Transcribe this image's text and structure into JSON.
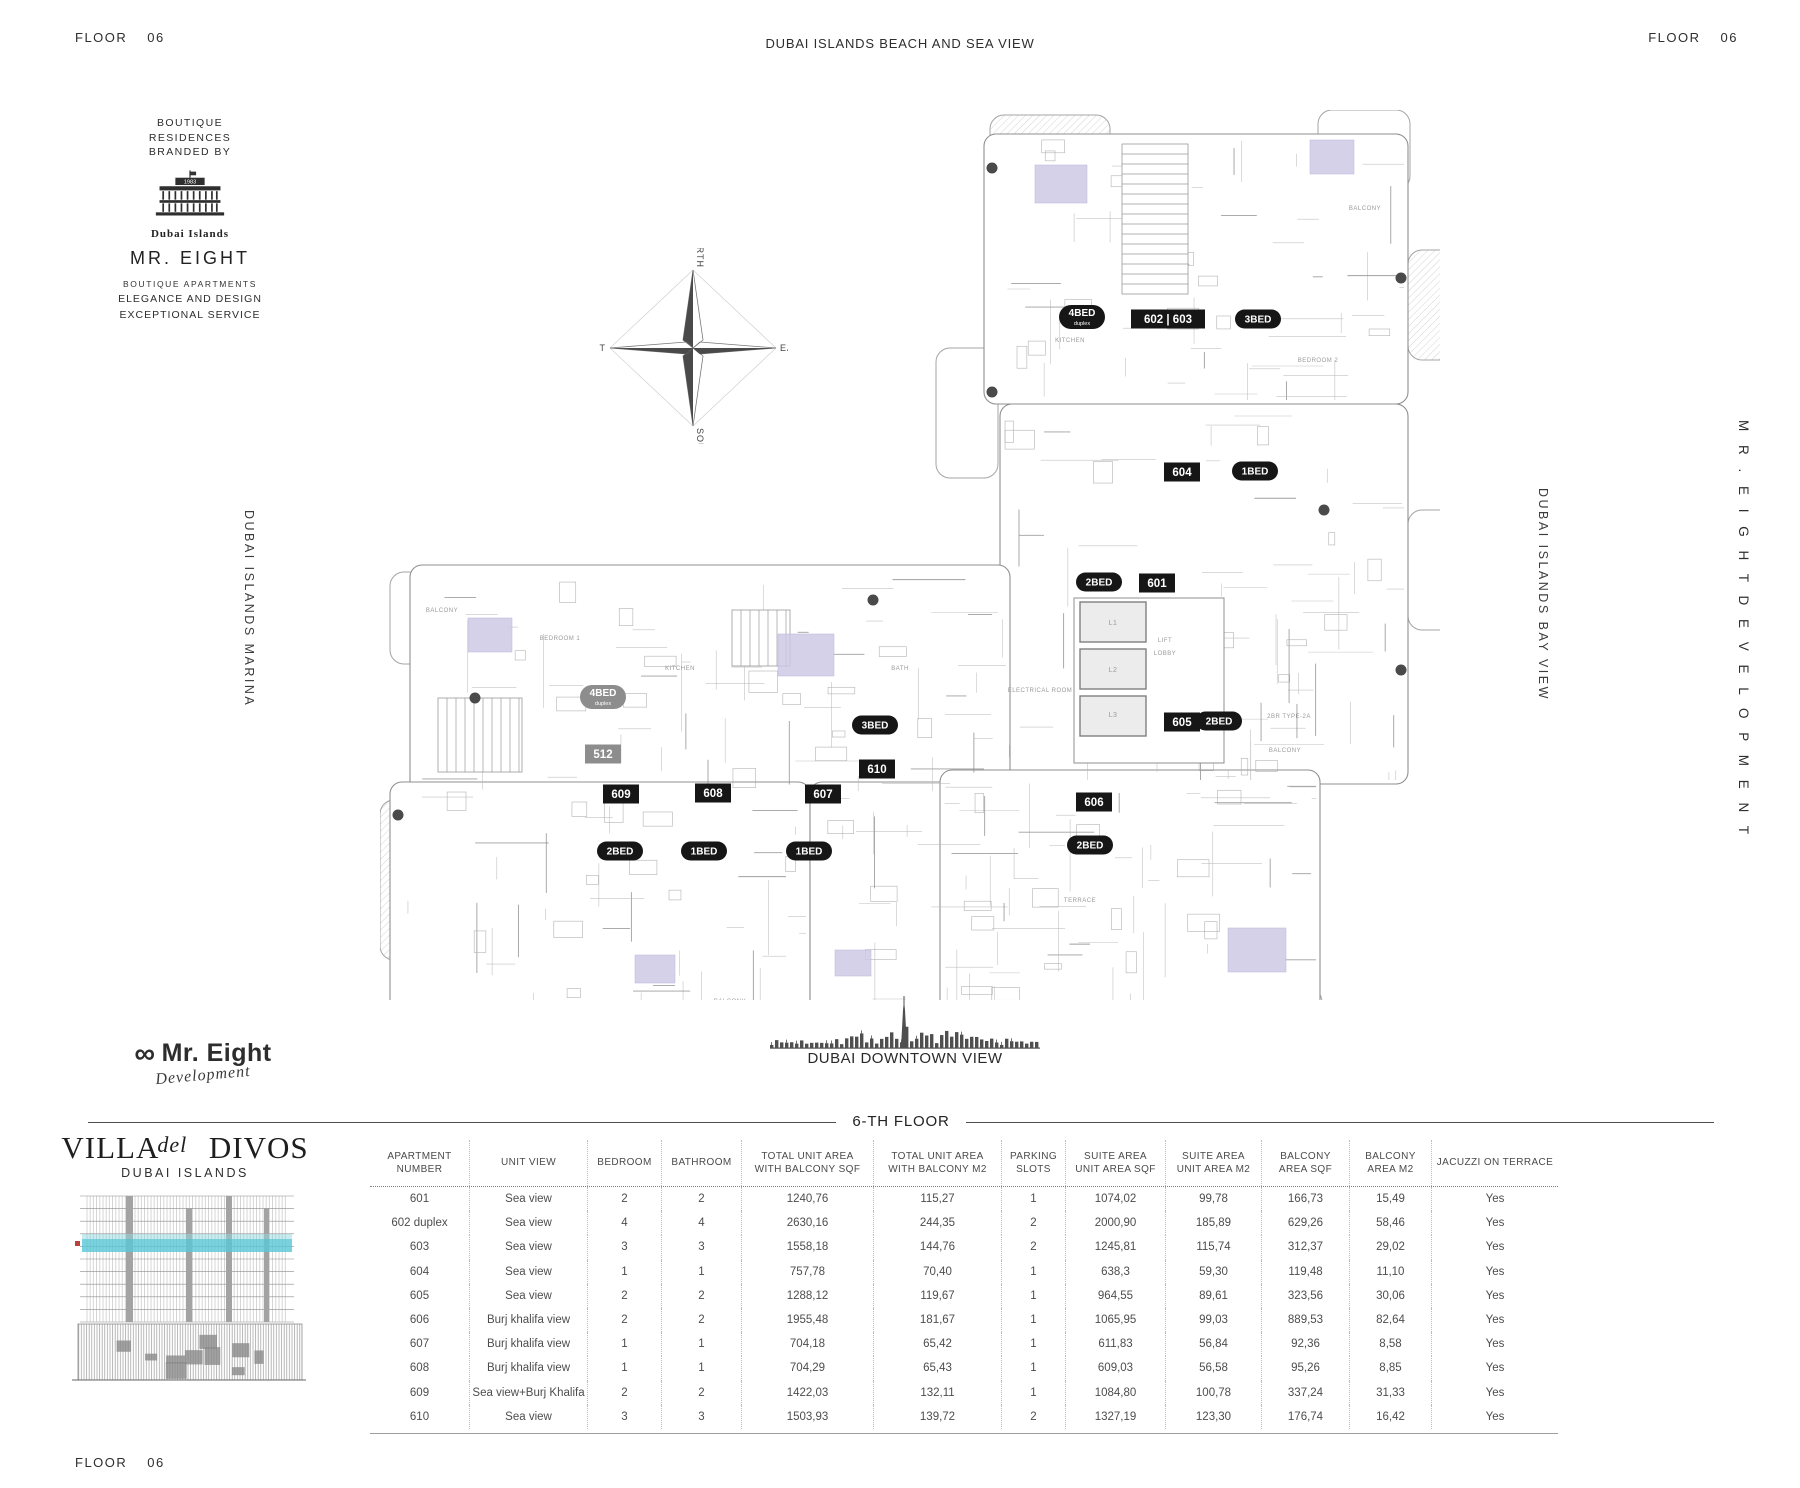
{
  "header": {
    "floor_label": "FLOOR",
    "floor_number": "06",
    "center_title": "DUBAI ISLANDS BEACH AND SEA VIEW"
  },
  "branding_top": {
    "intro_lines": "BOUTIQUE\nRESIDENCES\nBRANDED BY",
    "logo_year": "1983",
    "logo_caption": "Dubai Islands",
    "name": "MR. EIGHT",
    "tagline1": "BOUTIQUE APARTMENTS",
    "tagline2": "ELEGANCE AND DESIGN",
    "tagline3": "EXCEPTIONAL SERVICE"
  },
  "side_labels": {
    "left": "DUBAI ISLANDS MARINA",
    "right_inner": "DUBAI ISLANDS BAY VIEW",
    "right_outer": "M R .   E I G H T   D E V E L O P M E N T"
  },
  "compass": {
    "north": "NORTH",
    "south": "SOUTH",
    "east": "EAST",
    "west": "WEST"
  },
  "plan": {
    "unit_labels": [
      {
        "kind": "pill",
        "tone": "gray",
        "text": "4BED",
        "sub": "duplex",
        "x": 223,
        "y": 587
      },
      {
        "kind": "rect",
        "tone": "gray",
        "text": "512",
        "x": 223,
        "y": 644
      },
      {
        "kind": "pill",
        "tone": "dark",
        "text": "4BED",
        "sub": "duplex",
        "x": 702,
        "y": 207
      },
      {
        "kind": "rect",
        "tone": "dark",
        "text": "602 | 603",
        "x": 788,
        "y": 209
      },
      {
        "kind": "pill",
        "tone": "dark",
        "text": "3BED",
        "x": 878,
        "y": 209
      },
      {
        "kind": "rect",
        "tone": "dark",
        "text": "604",
        "x": 802,
        "y": 362
      },
      {
        "kind": "pill",
        "tone": "dark",
        "text": "1BED",
        "x": 875,
        "y": 361
      },
      {
        "kind": "pill",
        "tone": "dark",
        "text": "2BED",
        "x": 719,
        "y": 472
      },
      {
        "kind": "rect",
        "tone": "dark",
        "text": "601",
        "x": 777,
        "y": 473
      },
      {
        "kind": "rect",
        "tone": "dark",
        "text": "605",
        "x": 802,
        "y": 612
      },
      {
        "kind": "pill",
        "tone": "dark",
        "text": "2BED",
        "x": 839,
        "y": 611
      },
      {
        "kind": "pill",
        "tone": "dark",
        "text": "3BED",
        "x": 495,
        "y": 615
      },
      {
        "kind": "rect",
        "tone": "dark",
        "text": "610",
        "x": 497,
        "y": 659
      },
      {
        "kind": "rect",
        "tone": "dark",
        "text": "609",
        "x": 241,
        "y": 684
      },
      {
        "kind": "rect",
        "tone": "dark",
        "text": "608",
        "x": 333,
        "y": 683
      },
      {
        "kind": "rect",
        "tone": "dark",
        "text": "607",
        "x": 443,
        "y": 684
      },
      {
        "kind": "rect",
        "tone": "dark",
        "text": "606",
        "x": 714,
        "y": 692
      },
      {
        "kind": "pill",
        "tone": "dark",
        "text": "2BED",
        "x": 240,
        "y": 741
      },
      {
        "kind": "pill",
        "tone": "dark",
        "text": "1BED",
        "x": 324,
        "y": 741
      },
      {
        "kind": "pill",
        "tone": "dark",
        "text": "1BED",
        "x": 429,
        "y": 741
      },
      {
        "kind": "pill",
        "tone": "dark",
        "text": "2BED",
        "x": 710,
        "y": 735
      }
    ],
    "room_labels": [
      {
        "text": "LIFT",
        "x": 785,
        "y": 532
      },
      {
        "text": "LOBBY",
        "x": 785,
        "y": 545
      },
      {
        "text": "L1",
        "x": 733,
        "y": 515
      },
      {
        "text": "L2",
        "x": 733,
        "y": 562
      },
      {
        "text": "L3",
        "x": 733,
        "y": 607
      },
      {
        "text": "2BR TYPE-2A",
        "x": 909,
        "y": 608
      },
      {
        "text": "ELECTRICAL ROOM",
        "x": 660,
        "y": 582
      },
      {
        "text": "BALCONY",
        "x": 62,
        "y": 502
      },
      {
        "text": "BALCONY",
        "x": 985,
        "y": 100
      },
      {
        "text": "BALCONY",
        "x": 350,
        "y": 893
      },
      {
        "text": "BALCONY",
        "x": 905,
        "y": 642
      },
      {
        "text": "KITCHEN",
        "x": 300,
        "y": 560
      },
      {
        "text": "BEDROOM 1",
        "x": 180,
        "y": 530
      },
      {
        "text": "KITCHEN",
        "x": 690,
        "y": 232
      },
      {
        "text": "BEDROOM 2",
        "x": 938,
        "y": 252
      },
      {
        "text": "TERRACE",
        "x": 700,
        "y": 792
      },
      {
        "text": "BATH",
        "x": 520,
        "y": 560
      }
    ]
  },
  "downtown": {
    "caption": "DUBAI DOWNTOWN VIEW"
  },
  "section_title": "6-TH FLOOR",
  "dev_logo": {
    "infinity": "∞",
    "name": "Mr. Eight",
    "sub": "Development"
  },
  "villa_logo": {
    "title": "VILLA DIVOS",
    "script_word": "del",
    "subtitle": "DUBAI ISLANDS"
  },
  "table": {
    "col_headers": [
      [
        "APARTMENT",
        "NUMBER"
      ],
      [
        "UNIT VIEW"
      ],
      [
        "BEDROOM"
      ],
      [
        "BATHROOM"
      ],
      [
        "TOTAL UNIT AREA",
        "WITH BALCONY SQF"
      ],
      [
        "TOTAL  UNIT AREA",
        "WITH BALCONY M2"
      ],
      [
        "PARKING",
        "SLOTS"
      ],
      [
        "SUITE AREA",
        "UNIT AREA SQF"
      ],
      [
        "SUITE AREA",
        "UNIT AREA M2"
      ],
      [
        "BALCONY",
        "AREA SQF"
      ],
      [
        "BALCONY",
        "AREA M2"
      ],
      [
        "JACUZZI ON TERRACE"
      ]
    ],
    "rows": [
      [
        "601",
        "Sea view",
        "2",
        "2",
        "1240,76",
        "115,27",
        "1",
        "1074,02",
        "99,78",
        "166,73",
        "15,49",
        "Yes"
      ],
      [
        "602 duplex",
        "Sea view",
        "4",
        "4",
        "2630,16",
        "244,35",
        "2",
        "2000,90",
        "185,89",
        "629,26",
        "58,46",
        "Yes"
      ],
      [
        "603",
        "Sea view",
        "3",
        "3",
        "1558,18",
        "144,76",
        "2",
        "1245,81",
        "115,74",
        "312,37",
        "29,02",
        "Yes"
      ],
      [
        "604",
        "Sea view",
        "1",
        "1",
        "757,78",
        "70,40",
        "1",
        "638,3",
        "59,30",
        "119,48",
        "11,10",
        "Yes"
      ],
      [
        "605",
        "Sea view",
        "2",
        "2",
        "1288,12",
        "119,67",
        "1",
        "964,55",
        "89,61",
        "323,56",
        "30,06",
        "Yes"
      ],
      [
        "606",
        "Burj khalifa view",
        "2",
        "2",
        "1955,48",
        "181,67",
        "1",
        "1065,95",
        "99,03",
        "889,53",
        "82,64",
        "Yes"
      ],
      [
        "607",
        "Burj khalifa view",
        "1",
        "1",
        "704,18",
        "65,42",
        "1",
        "611,83",
        "56,84",
        "92,36",
        "8,58",
        "Yes"
      ],
      [
        "608",
        "Burj khalifa view",
        "1",
        "1",
        "704,29",
        "65,43",
        "1",
        "609,03",
        "56,58",
        "95,26",
        "8,85",
        "Yes"
      ],
      [
        "609",
        "Sea view+Burj Khalifa",
        "2",
        "2",
        "1422,03",
        "132,11",
        "1",
        "1084,80",
        "100,78",
        "337,24",
        "31,33",
        "Yes"
      ],
      [
        "610",
        "Sea view",
        "3",
        "3",
        "1503,93",
        "139,72",
        "2",
        "1327,19",
        "123,30",
        "176,74",
        "16,42",
        "Yes"
      ]
    ]
  },
  "footer": {
    "floor_label": "FLOOR",
    "floor_number": "06"
  }
}
